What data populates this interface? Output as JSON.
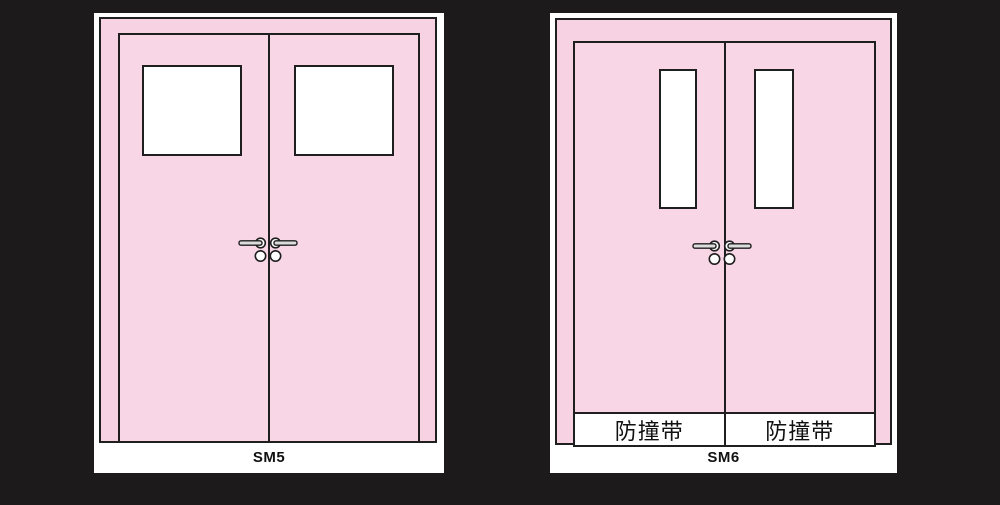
{
  "canvas": {
    "background_color": "#1c1a1b"
  },
  "colors": {
    "door_pink": "#f7d2e3",
    "leaf_pink": "#f8d6e6",
    "panel_white": "#ffffff",
    "outline": "#1f1f1f",
    "handle_fill": "#dcdcdc",
    "label_text": "#111111"
  },
  "doors": [
    {
      "label": "SM5",
      "window_shape": "square",
      "window_count": 2,
      "bands": []
    },
    {
      "label": "SM6",
      "window_shape": "tall-narrow",
      "window_count": 2,
      "bands": [
        {
          "text": "防撞带"
        },
        {
          "text": "防撞带"
        }
      ]
    }
  ],
  "icons": {
    "handles": "door-lever-handle-icon",
    "lock": "lock-cylinder-icon"
  }
}
